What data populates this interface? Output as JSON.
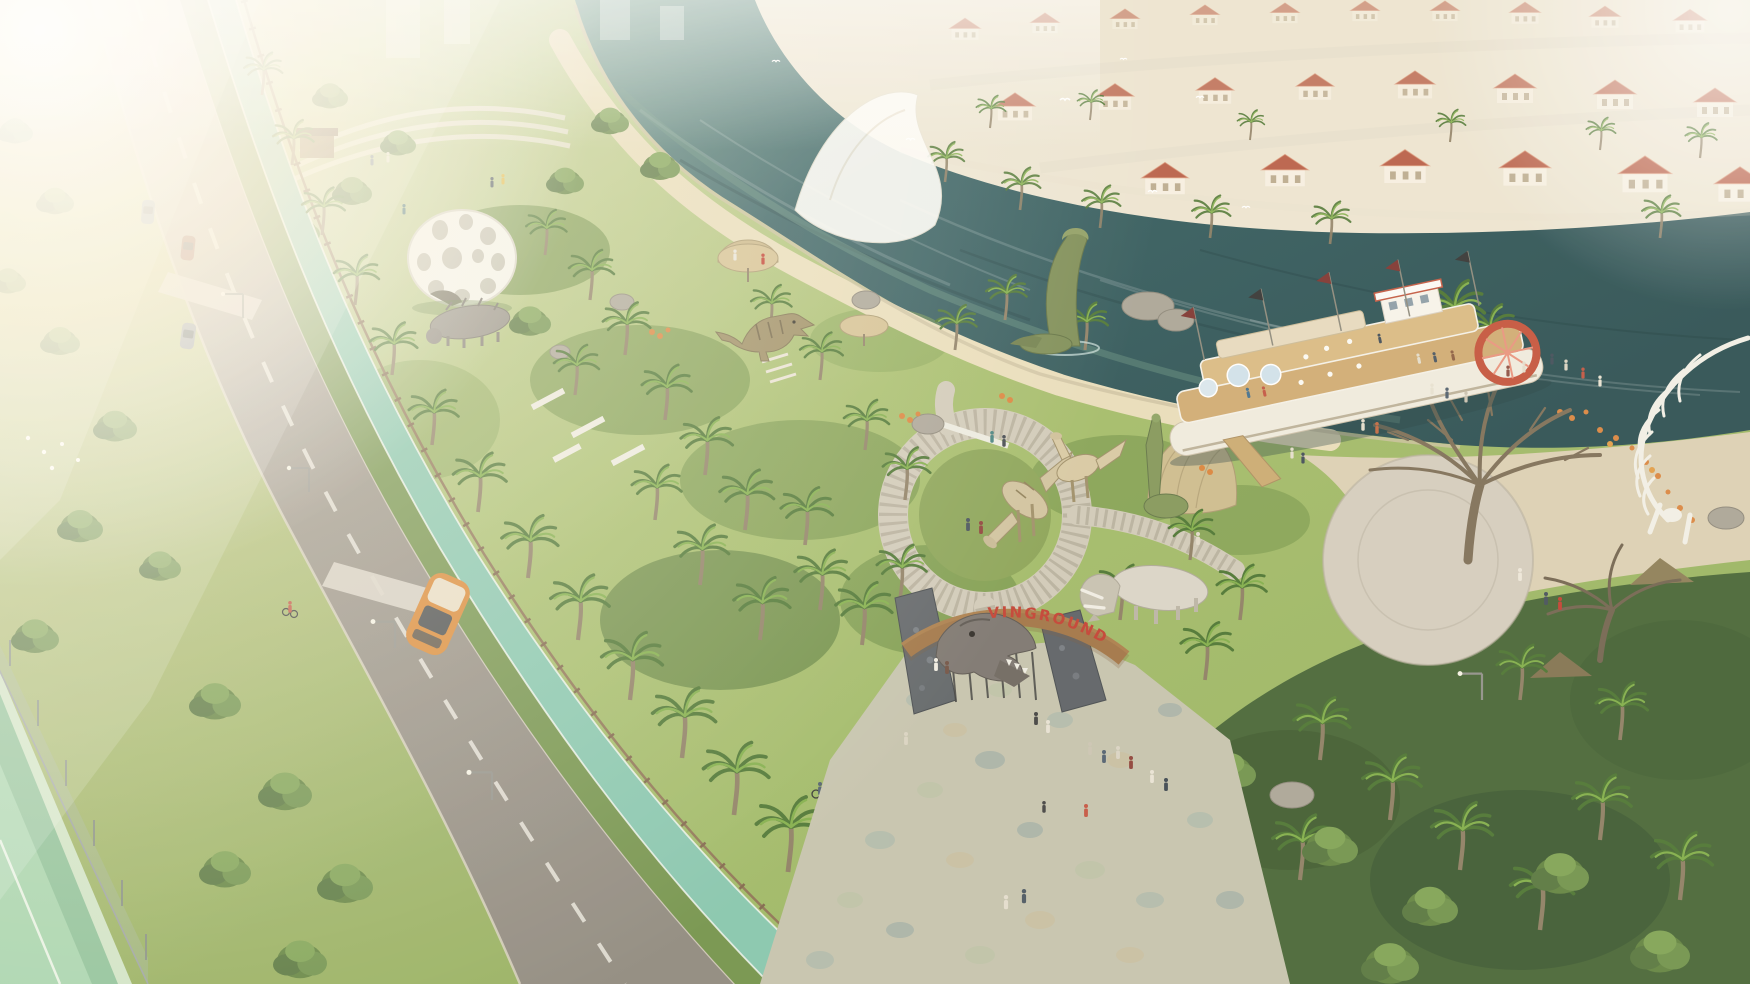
{
  "meta": {
    "title": "Aerial rendering of a riverside dinosaur theme park beside a villa neighborhood"
  },
  "sign": {
    "text": "VINGROUND",
    "color": "#c0392b"
  },
  "colors": {
    "water": "#2f5a5c",
    "water_light": "#6e9b8e",
    "road": "#9b9488",
    "bike_lane": "#82c4ab",
    "lawn": "#8fae58",
    "sand_path": "#e8dcb8",
    "stone_plaza": "#c3c1ab",
    "roof_red": "#b65a42",
    "paddle_wheel": "#c24f36",
    "skeleton": "#f1efe6"
  },
  "landmarks": {
    "river": "river",
    "villas": "red-roof villa neighborhood",
    "cruise_boat": "double-deck river cruise boat",
    "plesiosaur": "plesiosaur statue in water",
    "entrance_gate": "stone entrance gate with T-rex head",
    "gate_sign": "wooden arch sign",
    "triceratops": "triceratops statue",
    "raptors": "raptor statues on circular plaza",
    "allosaurus": "allosaurus statue by river path",
    "skeleton": "white dinosaur skeleton sculpture",
    "dome": "white perforated dome pavilion",
    "tent": "white event tent",
    "bike_lane": "green cycle track",
    "road": "tree-lined avenue",
    "tennis_court": "tennis court",
    "jungle": "dense jungle corner",
    "promenade": "riverside promenade"
  }
}
